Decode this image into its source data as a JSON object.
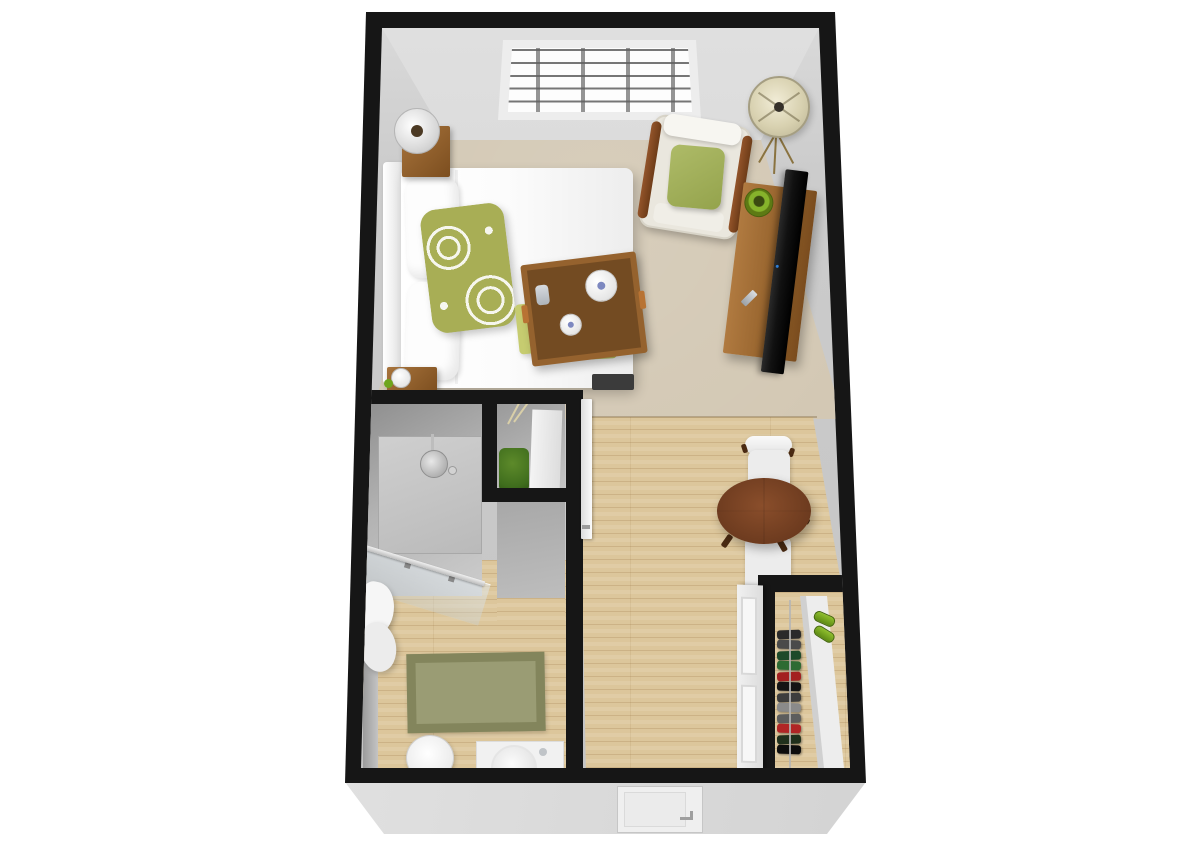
{
  "scene": {
    "type": "3D floor plan render",
    "unit": "studio apartment",
    "view": "top-down perspective",
    "background": "#ffffff"
  },
  "palette": {
    "wall": "#161616",
    "exterior-face": "#dcdcdc",
    "interior-face": "#c4c4c4",
    "carpet": "#cfc3ad",
    "wood": "#dcc69b",
    "rug": "#9a9c74",
    "rug-border": "#83855c",
    "accent-green": "#a8ae55",
    "leaf-green": "#6fa51c",
    "basket-green": "#3f6d1d",
    "towel-green": "#c6cc70",
    "furniture-wood": "#9c6a33",
    "dark-wood": "#6e4418",
    "table-wood": "#6d3b1f",
    "fabric-white": "#f4f4f4",
    "tv-black": "#191919"
  },
  "rooms": {
    "bedroom": {
      "label": "Bedroom and living area",
      "floor": "carpet",
      "window": {
        "columns": 4,
        "rows": 5
      },
      "furniture": [
        "bed with white duvet",
        "headboard",
        "two white pillows",
        "green damask accent pillow",
        "wood serving tray with tea set",
        "green folded towels",
        "two wood nightstands",
        "table lamp",
        "water glass",
        "armchair with green throw pillow",
        "tripod floor lamp",
        "wood media console",
        "flat-screen TV",
        "green decorative bowl",
        "remote"
      ]
    },
    "bathroom": {
      "label": "Bathroom",
      "floor": "wood",
      "fixtures": [
        "walk-in shower",
        "rain shower head",
        "glass partition",
        "storage niche with shelf",
        "green wicker basket",
        "white towels",
        "olive bath rug",
        "toilet",
        "sink with round basin"
      ]
    },
    "hallway": {
      "label": "Hallway and dining nook",
      "floor": "wood",
      "furniture": [
        "round wood dining table",
        "two white chairs",
        "open bathroom door"
      ]
    },
    "closet": {
      "label": "Closet",
      "floor": "wood",
      "clothes_colors": [
        "#2a2a2a",
        "#4a4a4a",
        "#1d4a2a",
        "#2e6b33",
        "#a32020",
        "#141414",
        "#3d3d3d",
        "#8a8a8a",
        "#5d5d5d",
        "#b02525",
        "#20301c",
        "#0d0d0d"
      ],
      "furniture": [
        "hanging clothes on rod",
        "white shoe shelf",
        "green shoes",
        "white sliding doors"
      ]
    }
  },
  "entry": {
    "label": "Entry door"
  }
}
